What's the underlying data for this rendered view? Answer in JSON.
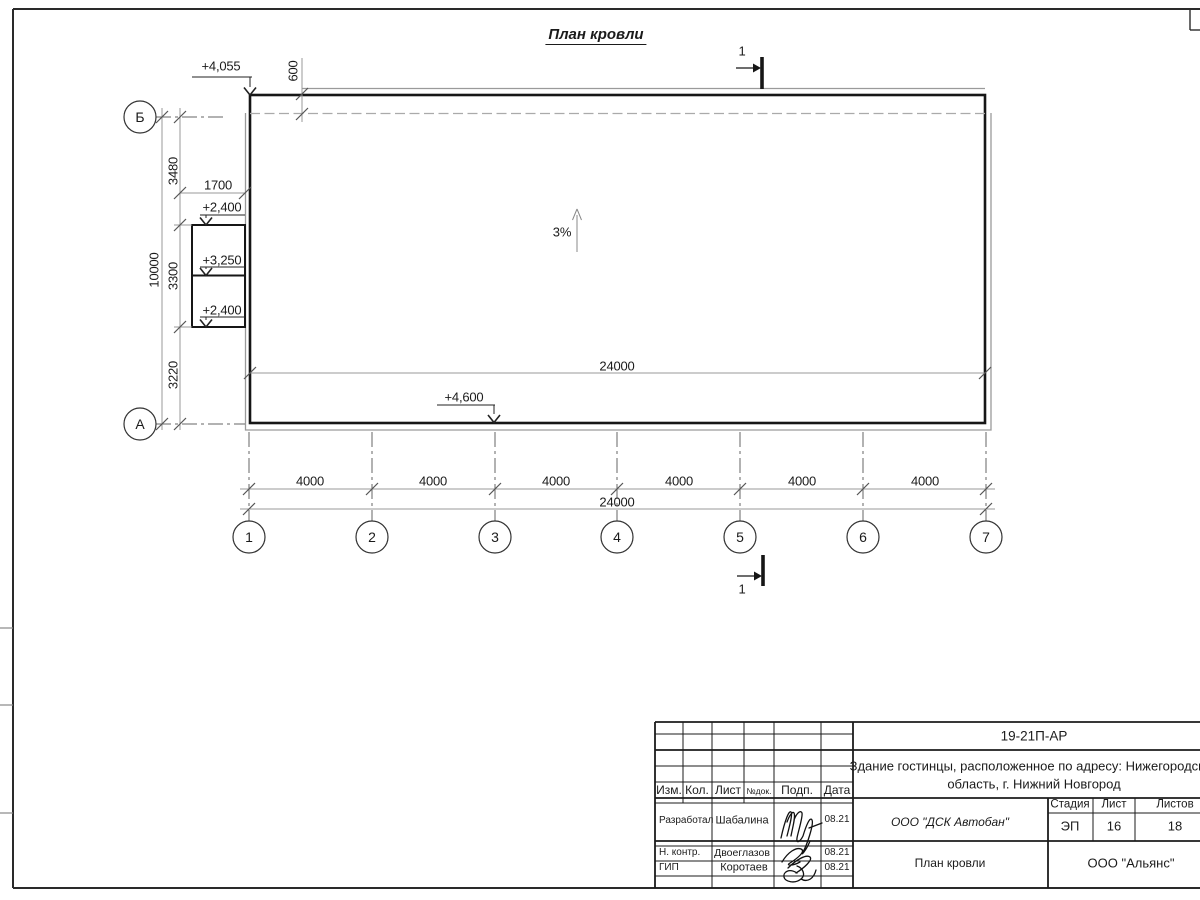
{
  "title": "План кровли",
  "plan": {
    "slope_label": "3%",
    "section_mark": "1",
    "elevations": {
      "top_left": "+4,055",
      "canopy_top": "+2,400",
      "canopy_mid": "+3,250",
      "canopy_bottom": "+2,400",
      "bottom": "+4,600"
    },
    "dims": {
      "parapet": "600",
      "canopy_offset": "1700",
      "left_segments": [
        "3480",
        "3300",
        "3220"
      ],
      "left_total": "10000",
      "inner_width": "24000",
      "bottom_segments": [
        "4000",
        "4000",
        "4000",
        "4000",
        "4000",
        "4000"
      ],
      "bottom_total": "24000"
    },
    "axes": {
      "horizontal": [
        "Б",
        "А"
      ],
      "vertical": [
        "1",
        "2",
        "3",
        "4",
        "5",
        "6",
        "7"
      ]
    }
  },
  "title_block": {
    "doc_code": "19-21П-АР",
    "project_name_line1": "Здание гостинцы, расположенное по адресу: Нижегородская",
    "project_name_line2": "область, г. Нижний Новгород",
    "columns": [
      "Изм.",
      "Кол.",
      "Лист",
      "№док.",
      "Подп.",
      "Дата"
    ],
    "rows": [
      {
        "role": "Разработал",
        "name": "Шабалина",
        "date": "08.21"
      },
      {
        "role": "Н. контр.",
        "name": "Двоеглазов",
        "date": "08.21"
      },
      {
        "role": "ГИП",
        "name": "Коротаев",
        "date": "08.21"
      }
    ],
    "org": "ООО \"ДСК Автобан\"",
    "stage_header": [
      "Стадия",
      "Лист",
      "Листов"
    ],
    "stage": "ЭП",
    "sheet_num": "16",
    "sheet_total": "18",
    "drawing_title": "План кровли",
    "company": "ООО \"Альянс\""
  }
}
